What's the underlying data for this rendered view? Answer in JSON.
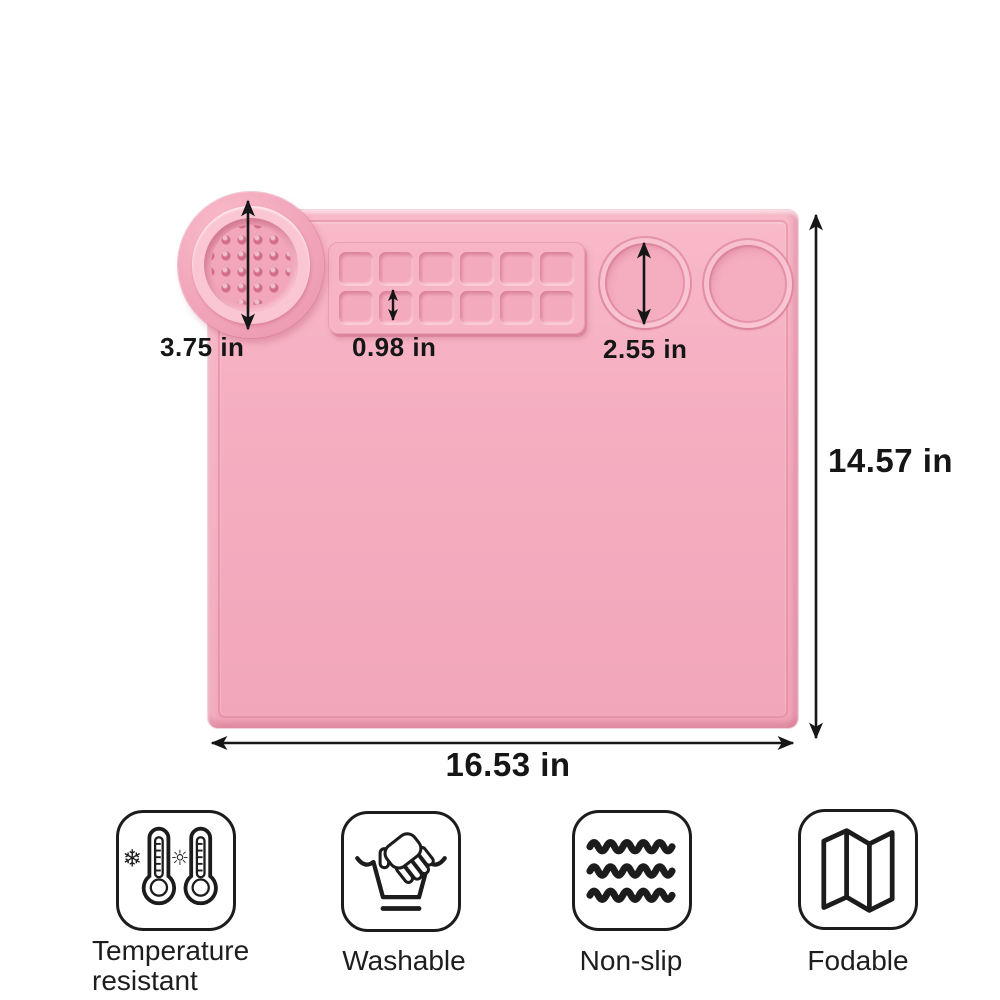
{
  "diagram_title": "silicone craft mat size diagram",
  "mat": {
    "color": "#f5adc0",
    "palette_wells": {
      "rows": 2,
      "cols": 6
    },
    "round_wells": 2,
    "has_brush_cleaning_cup": true
  },
  "labels": {
    "cup_diameter": "3.75 in",
    "palette_square": "0.98 in",
    "well_diameter": "2.55 in",
    "mat_height": "14.57 in",
    "mat_width": "16.53 in"
  },
  "features": [
    {
      "name": "temperature-resistant",
      "label": "Temperature\nresistant"
    },
    {
      "name": "washable",
      "label": "Washable"
    },
    {
      "name": "non-slip",
      "label": "Non-slip"
    },
    {
      "name": "fodable",
      "label": "Fodable"
    }
  ],
  "colors": {
    "mat": "#f5adc0",
    "mat_dark": "#e28ea8",
    "mat_light": "#fbc6d3",
    "ink": "#161616"
  }
}
